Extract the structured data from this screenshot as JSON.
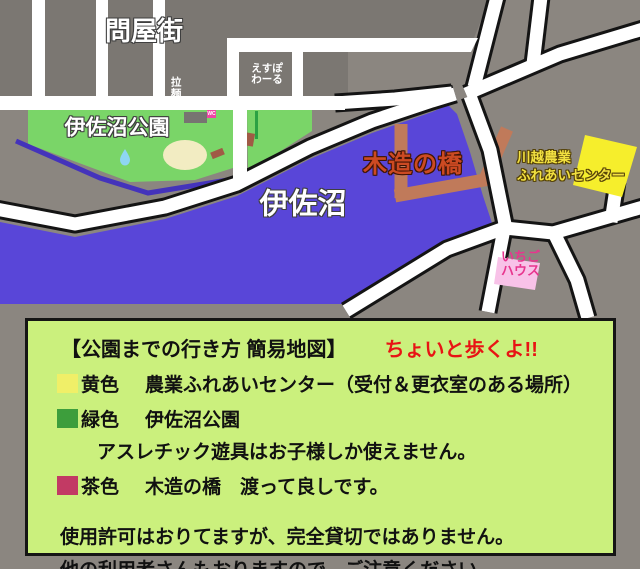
{
  "map": {
    "labels": {
      "district": "問屋街",
      "espoir_line1": "えすぽ",
      "espoir_line2": "わーる",
      "ramen": "拉麺",
      "park": "伊佐沼公園",
      "pond": "伊佐沼",
      "bridge": "木造の橋",
      "center_line1": "川越農業",
      "center_line2": "ふれあいセンター",
      "strawberry_line1": "いちご",
      "strawberry_line2": "ハウス",
      "wc": "WC"
    }
  },
  "colors": {
    "background": "#8b8680",
    "block": "#7b7772",
    "road": "#ffffff",
    "road_outline": "#141414",
    "pond": "#5946d8",
    "stream": "#4433bb",
    "park": "#7ad568",
    "sandbox": "#f2ecc2",
    "park_building": "#777471",
    "bench_brown": "#a05a45",
    "tree_line": "#2ba143",
    "water_drop": "#8ed6f2",
    "bridge": "#c07a5a",
    "bridge_label": "#cc4a22",
    "yellow_building": "#f6ee2c",
    "center_label": "#f2e040",
    "strawberry_house": "#f8c2e8",
    "strawberry_label": "#e8358e",
    "wc_sign": "#f043a5",
    "legend_bg": "#cbf07d",
    "legend_border": "#151515",
    "legend_note_red": "#e81414",
    "swatch_yellow": "#f0ef68",
    "swatch_green": "#3d9e3c",
    "swatch_brown": "#c23a64"
  },
  "legend": {
    "title": "【公園までの行き方 簡易地図】",
    "title_note": "ちょいと歩くよ!!",
    "items": [
      {
        "color_label": "黄色",
        "text": "農業ふれあいセンター（受付＆更衣室のある場所）"
      },
      {
        "color_label": "緑色",
        "text": "伊佐沼公園"
      },
      {
        "text": "アスレチック遊具はお子様しか使えません。"
      },
      {
        "color_label": "茶色",
        "text": "木造の橋　渡って良しです。"
      }
    ],
    "notes": [
      "使用許可はおりてますが、完全貸切ではありません。",
      "他の利用者さんもおりますので、ご注意ください。"
    ]
  }
}
